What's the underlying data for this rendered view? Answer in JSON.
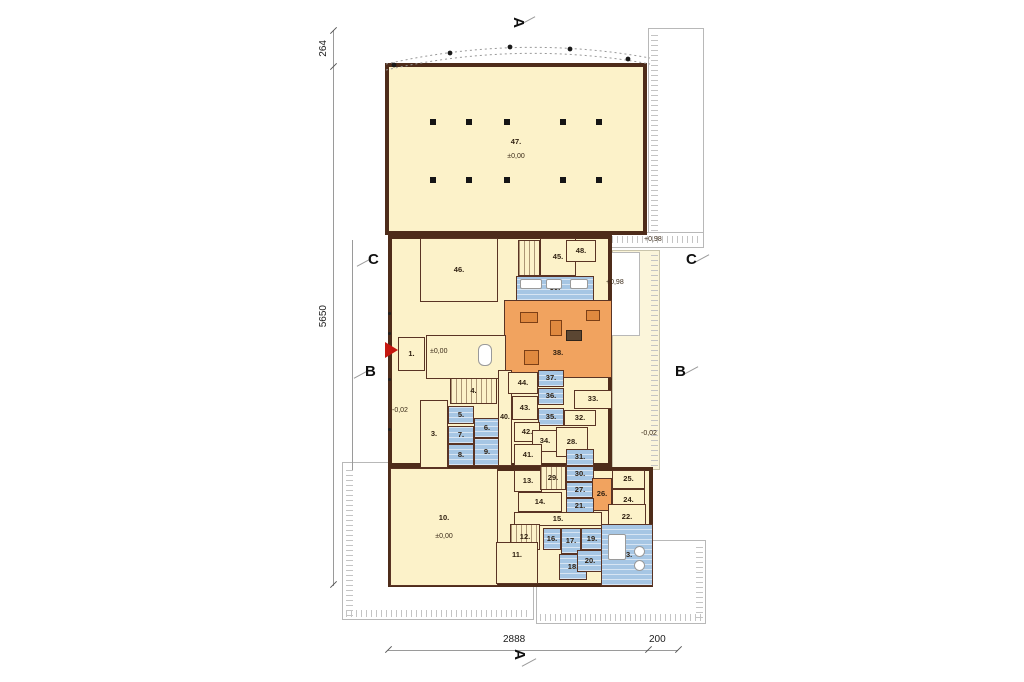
{
  "markers": {
    "a_top": "A",
    "a_bottom": "A",
    "c_left": "C",
    "c_right": "C",
    "b_left": "B",
    "b_right": "B"
  },
  "dimensions": {
    "v_top": "264",
    "v_main": "5650",
    "h_main": "2888",
    "h_right": "200"
  },
  "elevations": {
    "e000_hall": "±0,00",
    "e000_lobby": "±0,00",
    "e000_garage": "±0,00",
    "e098_terrace": "+0,98",
    "e098_ramp": "+0,98",
    "e002_west": "-0,02",
    "e002_east": "-0,02"
  },
  "rooms": [
    {
      "label": "1."
    },
    {
      "label": "2."
    },
    {
      "label": "3."
    },
    {
      "label": "4."
    },
    {
      "label": "5."
    },
    {
      "label": "6."
    },
    {
      "label": "7."
    },
    {
      "label": "8."
    },
    {
      "label": "9."
    },
    {
      "label": "10."
    },
    {
      "label": "11."
    },
    {
      "label": "12."
    },
    {
      "label": "13."
    },
    {
      "label": "14."
    },
    {
      "label": "15."
    },
    {
      "label": "16."
    },
    {
      "label": "17."
    },
    {
      "label": "18."
    },
    {
      "label": "19."
    },
    {
      "label": "20."
    },
    {
      "label": "21."
    },
    {
      "label": "22."
    },
    {
      "label": "23."
    },
    {
      "label": "24."
    },
    {
      "label": "25."
    },
    {
      "label": "26."
    },
    {
      "label": "27."
    },
    {
      "label": "28."
    },
    {
      "label": "29."
    },
    {
      "label": "30."
    },
    {
      "label": "31."
    },
    {
      "label": "32."
    },
    {
      "label": "33."
    },
    {
      "label": "34."
    },
    {
      "label": "35."
    },
    {
      "label": "36."
    },
    {
      "label": "37."
    },
    {
      "label": "38."
    },
    {
      "label": "39."
    },
    {
      "label": "40."
    },
    {
      "label": "41."
    },
    {
      "label": "42."
    },
    {
      "label": "43."
    },
    {
      "label": "44."
    },
    {
      "label": "45."
    },
    {
      "label": "46."
    },
    {
      "label": "47."
    },
    {
      "label": "48."
    }
  ],
  "colors": {
    "room_cream": "#fcf2c9",
    "room_blue": "#a6c6e4",
    "room_orange": "#f1a35f",
    "wall_dark": "#4e2c1a",
    "wall_brick": "#b5673a",
    "deck_pale": "#fbf5da",
    "terrace_white": "#ffffff",
    "entrance_red": "#c51710",
    "dim_gray": "#9a9a9a"
  }
}
